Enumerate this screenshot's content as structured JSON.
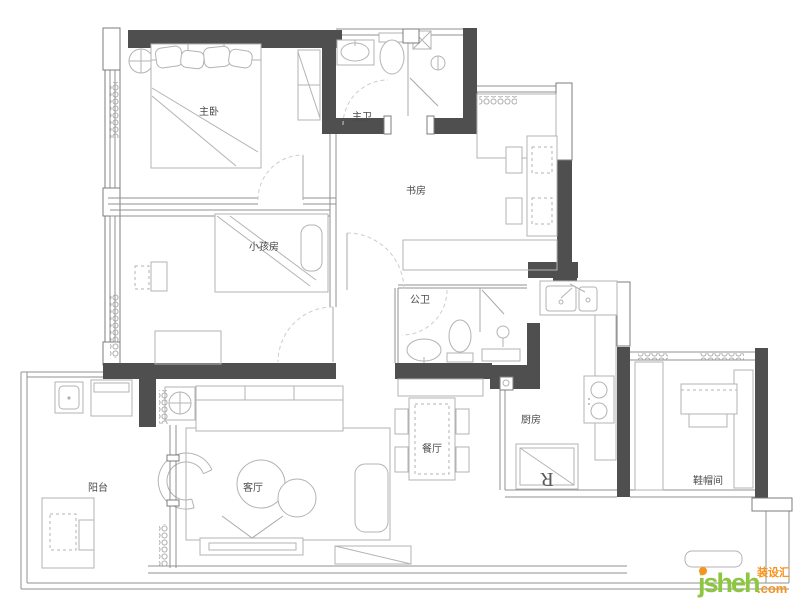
{
  "canvas": {
    "width": 800,
    "height": 599
  },
  "colors": {
    "wall": "#4f4f4f",
    "thin_line": "#909090",
    "furniture_line": "#b3b3b3",
    "label_text": "#4a4a4a",
    "watermark_green": "#8dc63f",
    "watermark_orange": "#f7941d"
  },
  "rooms": {
    "master_bedroom": {
      "label": "主卧"
    },
    "master_bath": {
      "label": "主卫"
    },
    "study": {
      "label": "书房"
    },
    "kids_room": {
      "label": "小孩房"
    },
    "public_bath": {
      "label": "公卫"
    },
    "dining": {
      "label": "餐厅"
    },
    "kitchen": {
      "label": "厨房"
    },
    "living": {
      "label": "客厅"
    },
    "balcony": {
      "label": "阳台"
    },
    "cloakroom": {
      "label": "鞋帽间"
    }
  },
  "fixtures": {
    "fridge_label": "R"
  },
  "watermark": {
    "name": "jsheh",
    "suffix": ".com",
    "brand": "装设汇"
  }
}
